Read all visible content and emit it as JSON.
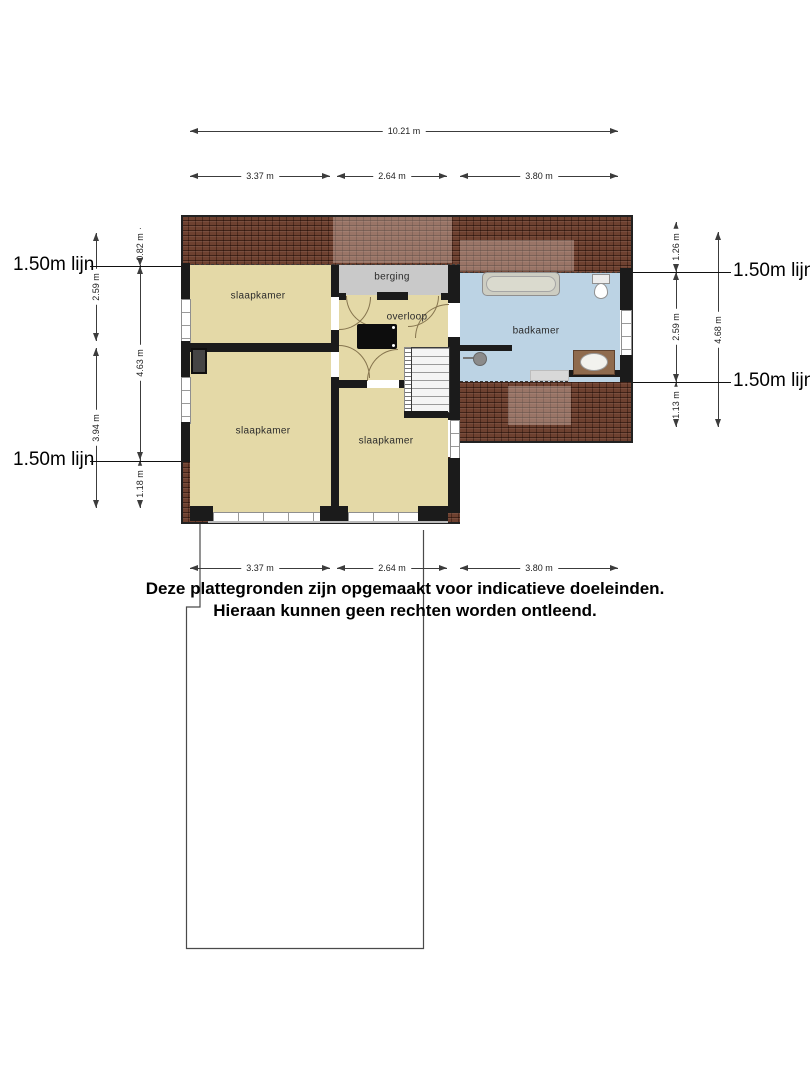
{
  "dims": {
    "top_total": "10.21 m",
    "top_segments": [
      "3.37 m",
      "2.64 m",
      "3.80 m"
    ],
    "bottom_segments": [
      "3.37 m",
      "2.64 m",
      "3.80 m"
    ],
    "left_outer_segments": [
      "2.59 m",
      "3.94 m"
    ],
    "left_inner_segments": [
      "0.82 m",
      "4.63 m",
      "1.18 m"
    ],
    "right_inner_segments": [
      "1.26 m",
      "2.59 m",
      "1.13 m"
    ],
    "right_outer_segment": "4.68 m",
    "height_line_label": "1.50m lijn"
  },
  "rooms": {
    "bedroom_top_left": "slaapkamer",
    "storage": "berging",
    "landing": "overloop",
    "bathroom": "badkamer",
    "bedroom_bottom_left": "slaapkamer",
    "bedroom_bottom_middle": "slaapkamer"
  },
  "disclaimer": {
    "line1": "Deze plattegronden zijn opgemaakt voor indicatieve doeleinden.",
    "line2": "Hieraan kunnen geen rechten worden ontleend."
  },
  "colors": {
    "room_fill": "#e4d9a7",
    "storage_fill": "#c9c9c9",
    "bathroom_fill": "#bcd3e4",
    "roof": "#6e4130",
    "wall": "#1b1b1b",
    "dim_line": "#3c3c3c"
  }
}
